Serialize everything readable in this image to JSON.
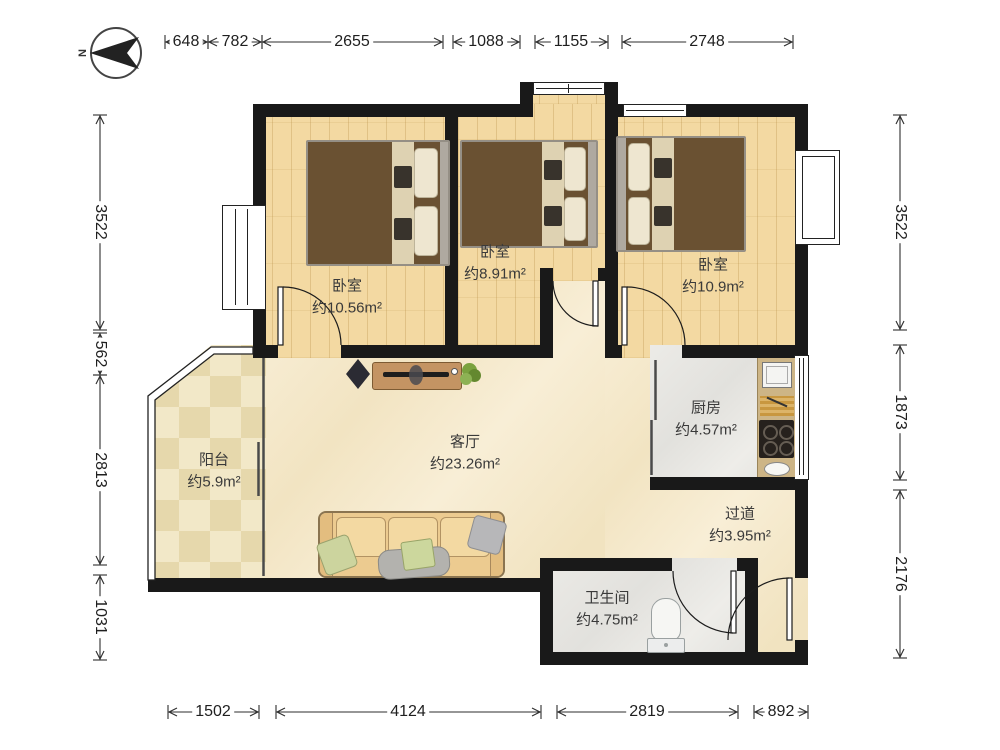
{
  "compass": {
    "label": "N"
  },
  "dimensions": {
    "top": [
      "648",
      "782",
      "2655",
      "1088",
      "1155",
      "2748"
    ],
    "bottom": [
      "1502",
      "4124",
      "2819",
      "892"
    ],
    "left": [
      "3522",
      "562",
      "2813",
      "1031"
    ],
    "right": [
      "3522",
      "1873",
      "2176"
    ]
  },
  "rooms": {
    "bedroom1": {
      "name": "卧室",
      "area": "约10.56m²"
    },
    "bedroom2": {
      "name": "卧室",
      "area": "约8.91m²"
    },
    "bedroom3": {
      "name": "卧室",
      "area": "约10.9m²"
    },
    "kitchen": {
      "name": "厨房",
      "area": "约4.57m²"
    },
    "living": {
      "name": "客厅",
      "area": "约23.26m²"
    },
    "balcony": {
      "name": "阳台",
      "area": "约5.9m²"
    },
    "hallway": {
      "name": "过道",
      "area": "约3.95m²"
    },
    "bathroom": {
      "name": "卫生间",
      "area": "约4.75m²"
    }
  },
  "colors": {
    "wall": "#191919",
    "wood_floor": "#f3d9a2",
    "marble_floor": "#f6ecd4",
    "gray_tile": "#e9e8e4",
    "bed_blanket": "#6a5132",
    "sofa": "#eccb90",
    "counter": "#cdb586",
    "plant": "#7aa23f"
  }
}
